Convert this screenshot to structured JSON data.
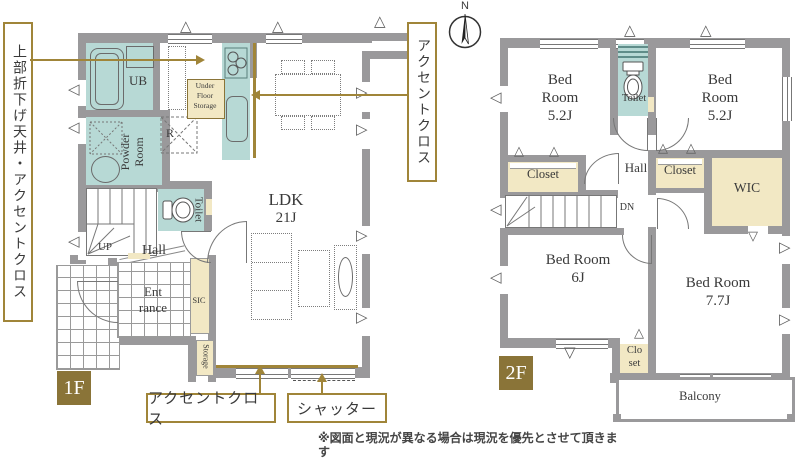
{
  "callouts": {
    "ceiling_accent": "上部折下げ天井・アクセントクロス",
    "accent_cloth_top": "アクセントクロス",
    "accent_cloth_bottom": "アクセントクロス",
    "shutter": "シャッター"
  },
  "compass": {
    "north": "N"
  },
  "floor1": {
    "badge": "1F",
    "ub": "UB",
    "under_floor_storage": "Under Floor Storage",
    "powder_room": "Powder Room",
    "refrigerator": "R",
    "toilet": "Toilet",
    "ldk_name": "LDK",
    "ldk_size": "21J",
    "up": "UP",
    "hall": "Hall",
    "entrance_line1": "Ent",
    "entrance_line2": "rance",
    "sic": "SIC",
    "storage": "Storage"
  },
  "floor2": {
    "badge": "2F",
    "bedroom_nw_name": "Bed Room",
    "bedroom_nw_size": "5.2J",
    "bedroom_ne_name": "Bed Room",
    "bedroom_ne_size": "5.2J",
    "bedroom_sw_name": "Bed Room",
    "bedroom_sw_size": "6J",
    "bedroom_se_name": "Bed Room",
    "bedroom_se_size": "7.7J",
    "toilet": "Toilet",
    "hall": "Hall",
    "down": "DN",
    "closet_west": "Closet",
    "closet_mid": "Closet",
    "wic": "WIC",
    "closet_south_line1": "Clo",
    "closet_south_line2": "set",
    "balcony": "Balcony"
  },
  "icons": {
    "vent_left": "◁",
    "vent_right": "▷",
    "vent_up": "△",
    "vent_down": "▽"
  },
  "colors": {
    "wall": "#9a999b",
    "water_room": "#b7d9d5",
    "closet": "#f2e8c4",
    "accent_gold": "#a08539",
    "floor_badge": "#8a7438"
  },
  "footer": {
    "disclaimer": "※図面と現況が異なる場合は現況を優先とさせて頂きます"
  }
}
